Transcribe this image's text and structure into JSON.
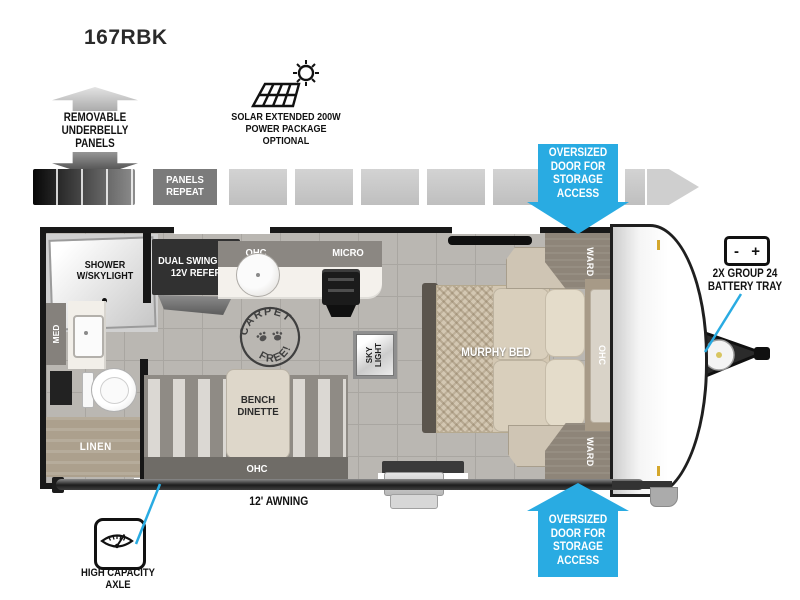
{
  "model": "167RBK",
  "colors": {
    "accent_blue": "#29ABE2",
    "wall_black": "#181818",
    "floor_gray": "#BAB7B2",
    "strip_gray": "#C9C9C9"
  },
  "callouts": {
    "underbelly": "REMOVABLE UNDERBELLY PANELS",
    "solar": "SOLAR EXTENDED 200W POWER PACKAGE OPTIONAL",
    "panels_repeat": "PANELS REPEAT",
    "oversized_door_top": "OVERSIZED DOOR FOR STORAGE ACCESS",
    "oversized_door_bottom": "OVERSIZED DOOR FOR STORAGE ACCESS",
    "battery_tray": "2X GROUP 24 BATTERY TRAY",
    "battery_minus": "-",
    "battery_plus": "+",
    "awning": "12' AWNING",
    "axle": "HIGH CAPACITY AXLE"
  },
  "floorplan": {
    "shower": "SHOWER W/SKYLIGHT",
    "med": "MED",
    "linen": "LINEN",
    "refer": "DUAL SWINGING 12V REFER",
    "kitchen_ohc": "OHC",
    "micro": "MICRO",
    "carpet_free_top": "CARPET",
    "carpet_free_bottom": "FREE!",
    "sky_light": "SKY LIGHT",
    "bench_dinette": "BENCH DINETTE",
    "dinette_ohc": "OHC",
    "murphy_bed": "MURPHY BED",
    "ward_front_top": "WARD",
    "ward_front_bottom": "WARD",
    "front_ohc": "OHC"
  }
}
